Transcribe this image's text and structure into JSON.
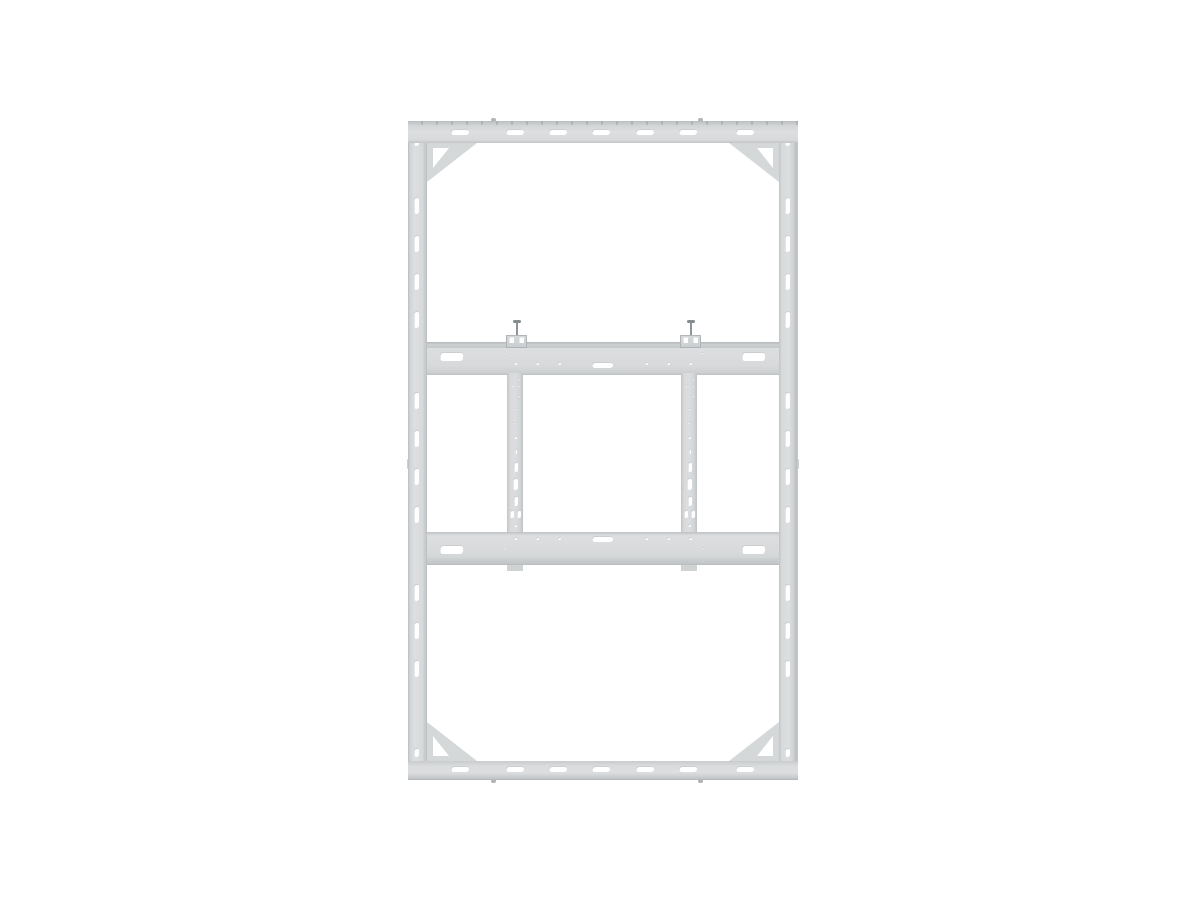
{
  "meta": {
    "image_type": "product-photo",
    "subject": "video-wall-mount-frame",
    "background": "#ffffff"
  },
  "colors": {
    "frame_fill": "#d8dadb",
    "frame_highlight": "#dcdee0",
    "frame_lip": "#c9cccd",
    "frame_edge": "#b4b8ba",
    "gusset_fill": "#d5d8d9",
    "clamp_fill": "#ced1d2",
    "screw": "#8f969a",
    "cutout": "#ffffff"
  },
  "parts": {
    "frame": "Wall mount frame",
    "top_rail": "Top rail with mounting slots",
    "bottom_rail": "Bottom rail with mounting slots",
    "left_rail": "Left side rail with slots",
    "right_rail": "Right side rail with slots",
    "gusset": "Corner gusset bracket",
    "upper_crossbar": "Upper display crossbar",
    "lower_crossbar": "Lower display crossbar",
    "vesa_rail": "Vertical VESA adapter rail",
    "clamp": "Display securing clamp",
    "screw": "Clamp securing screw"
  }
}
